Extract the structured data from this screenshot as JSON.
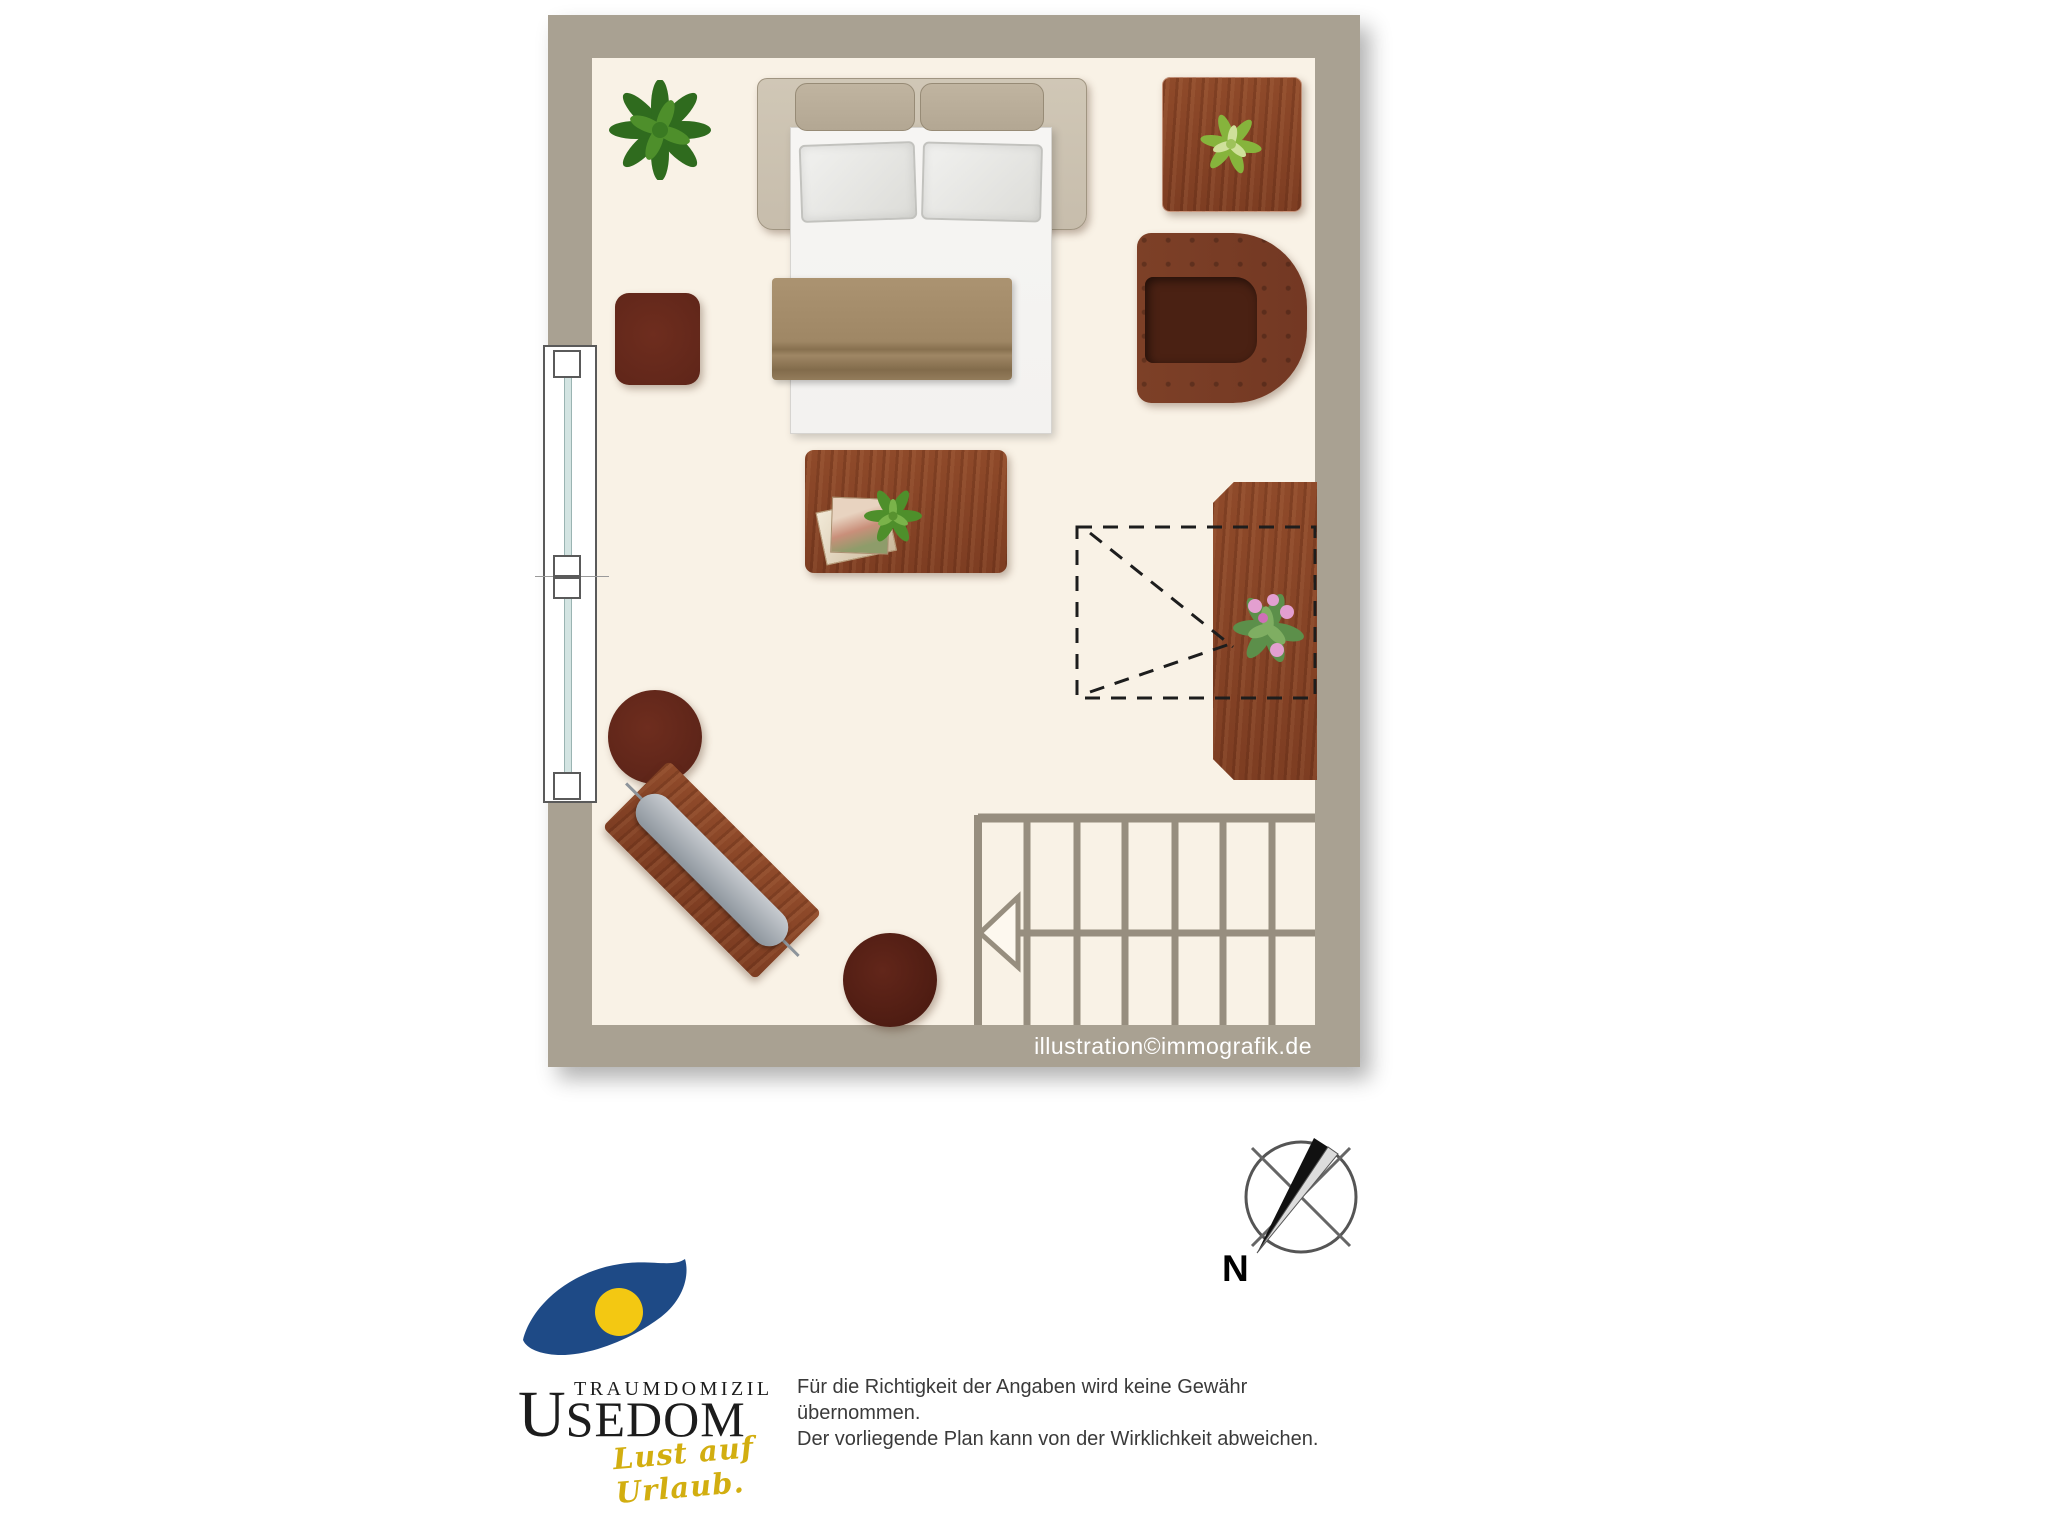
{
  "colors": {
    "wall": "#a9a192",
    "floor": "#f9f2e6",
    "wood": "#7d3d22",
    "wood-light": "#8f4a2a",
    "pouf": "#5e2519",
    "stool": "#4e1c12",
    "leather": "#733823",
    "seat": "#4a2113",
    "bedframe": "#c7bdac",
    "cushion": "#b3a793",
    "mattress": "#f3f2f0",
    "blanket": "#9f8765",
    "stairs": "#978e7f",
    "glass": "#d3e4e2",
    "logo-blue": "#1e4a86",
    "logo-yellow": "#f3c812",
    "tagline": "#d2ae10"
  },
  "plan": {
    "watermark": "illustration©immografik.de",
    "furniture": [
      "potted-plant",
      "double-sofa-bed",
      "side-table-with-plant",
      "leather-armchair",
      "square-pouf",
      "coffee-table-with-magazines-and-plant",
      "round-pouf",
      "angled-desk-with-board",
      "round-stool",
      "sideboard-with-flowering-plant",
      "skylight-dashed-outline",
      "staircase-with-direction-arrow",
      "window"
    ]
  },
  "compass": {
    "label": "N"
  },
  "logo": {
    "word_small": "TRAUMDOMIZIL",
    "word_big_initial": "U",
    "word_big_rest": "SEDOM",
    "tagline": "Lust auf Urlaub."
  },
  "disclaimer": {
    "line1": "Für die Richtigkeit der Angaben wird keine Gewähr übernommen.",
    "line2": "Der vorliegende Plan kann von der Wirklichkeit abweichen."
  }
}
